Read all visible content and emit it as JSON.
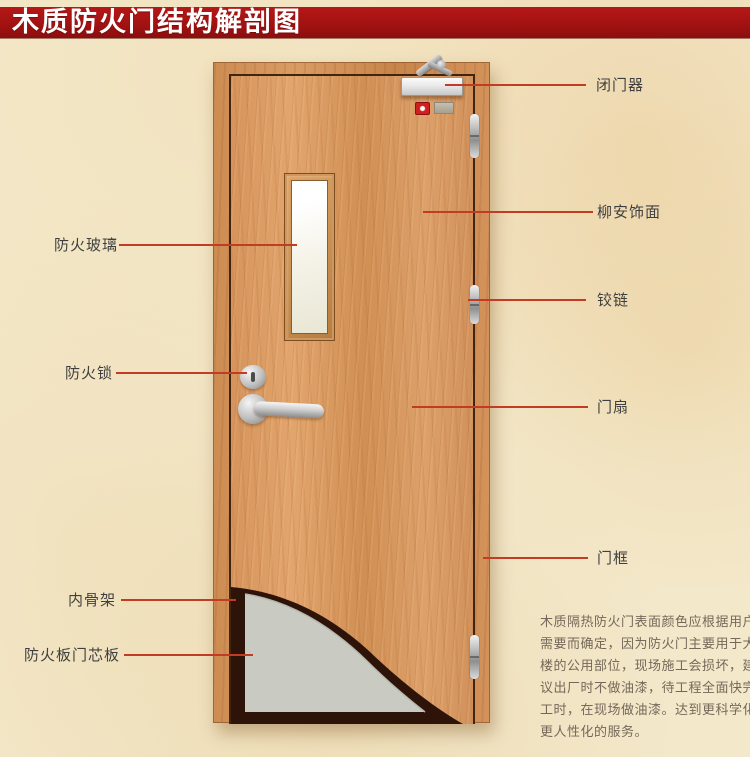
{
  "header": {
    "title": "木质防火门结构解剖图",
    "background_color": "#a31212",
    "text_color": "#ffffff"
  },
  "diagram": {
    "subject": "wooden fire door cutaway",
    "line_color": "#c13c22",
    "label_color": "#3f3f3f",
    "callouts_left": [
      {
        "label": "防火玻璃"
      },
      {
        "label": "防火锁"
      },
      {
        "label": "内骨架"
      },
      {
        "label": "防火板门芯板"
      }
    ],
    "callouts_right": [
      {
        "label": "闭门器"
      },
      {
        "label": "柳安饰面"
      },
      {
        "label": "铰链"
      },
      {
        "label": "门扇"
      },
      {
        "label": "门框"
      }
    ]
  },
  "description": {
    "text_color": "#75685a",
    "lines": [
      "木质隔热防火门表面颜色应根据用户",
      "需要而确定，因为防火门主要用于大",
      "楼的公用部位，现场施工会损坏，建",
      "议出厂时不做油漆，待工程全面快完",
      "工时，在现场做油漆。达到更科学化",
      "更人性化的服务。"
    ]
  },
  "colors": {
    "page_background": "#f3e8ca",
    "door_wood": "#d6945c",
    "frame_wood": "#cd8c52",
    "gap_line": "#42250f",
    "core_panel": "#c9cac2",
    "inner_skeleton": "#2e1408",
    "glass": "#f5f3e8",
    "hardware_metal": "#c0c0c0"
  }
}
